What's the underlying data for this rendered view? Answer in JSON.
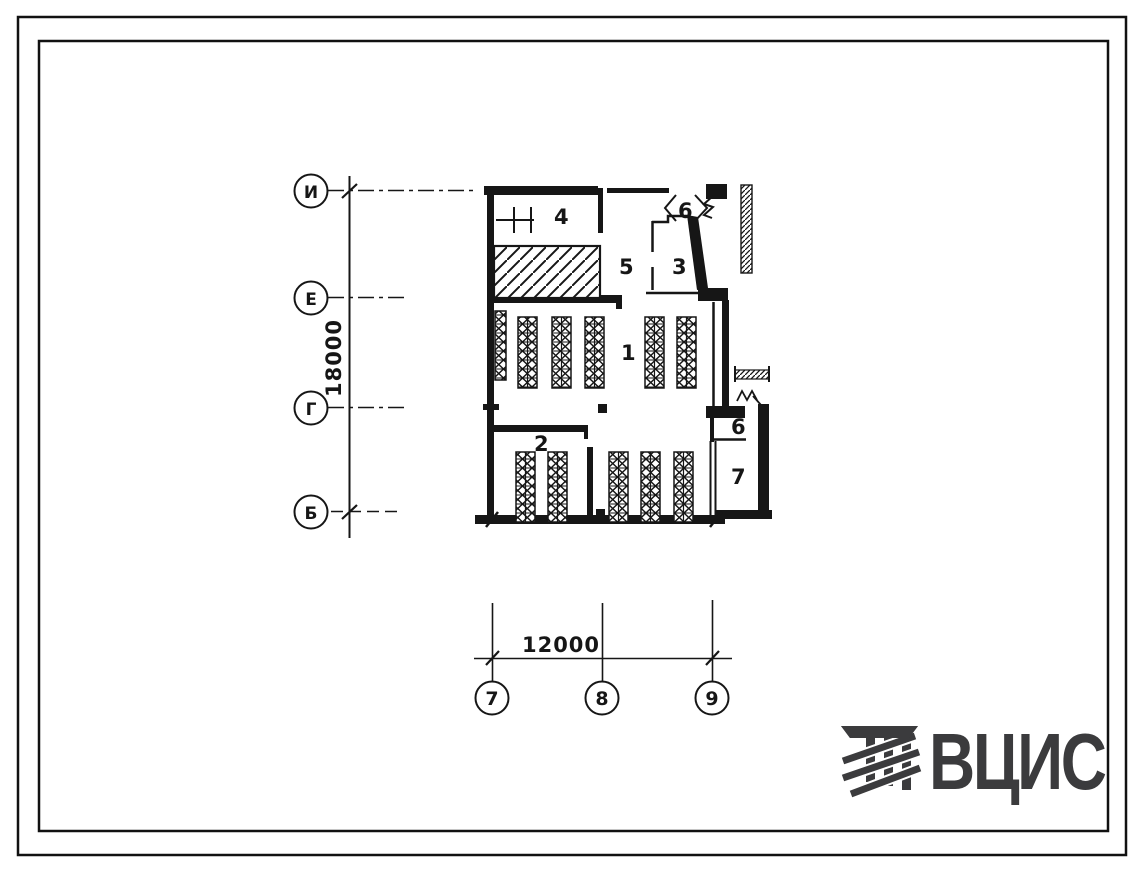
{
  "colors": {
    "ink": "#161616",
    "paper": "#ffffff",
    "logo": "#3b3b3d"
  },
  "axes": {
    "vertical": {
      "dimension": "18000",
      "markers": [
        {
          "label": "И"
        },
        {
          "label": "Е"
        },
        {
          "label": "Г"
        },
        {
          "label": "Б"
        }
      ]
    },
    "horizontal": {
      "dimension": "12000",
      "markers": [
        {
          "label": "7"
        },
        {
          "label": "8"
        },
        {
          "label": "9"
        }
      ]
    }
  },
  "plan": {
    "rooms": [
      {
        "number": "4"
      },
      {
        "number": "6"
      },
      {
        "number": "5"
      },
      {
        "number": "3"
      },
      {
        "number": "1"
      },
      {
        "number": "2"
      },
      {
        "number": "6"
      },
      {
        "number": "7"
      }
    ]
  },
  "logo": {
    "text": "ВЦИС"
  }
}
